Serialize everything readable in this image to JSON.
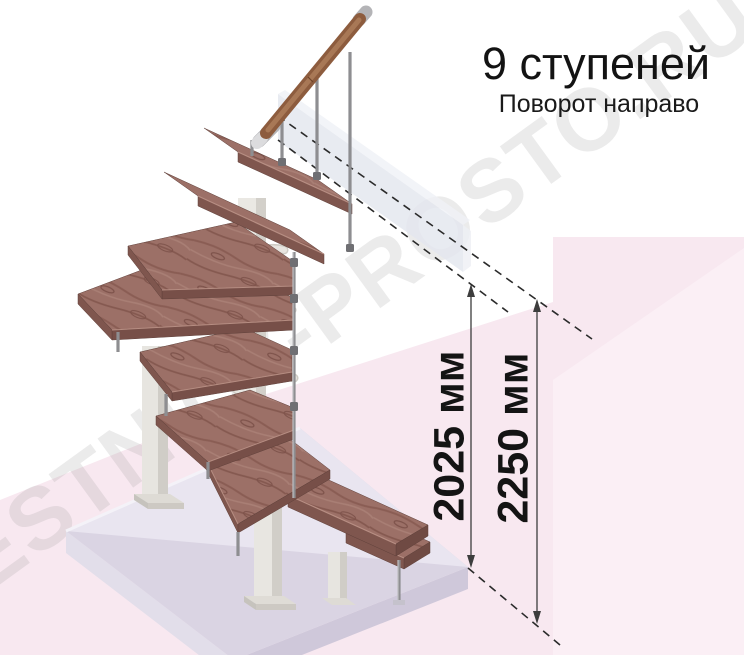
{
  "header": {
    "title": "9 ступеней",
    "subtitle": "Поворот направо"
  },
  "dimensions": [
    {
      "id": "clear-height",
      "label": "2025 мм"
    },
    {
      "id": "total-height",
      "label": "2250 мм"
    }
  ],
  "watermark": {
    "text": "LESTNICY-PROSTO.RU"
  },
  "illustration": {
    "type": "isometric-staircase",
    "steps_count": "9",
    "colors": {
      "wood": "#9c7067",
      "wood_edge": "#7f564e",
      "rail_wood": "#8d5c3e",
      "metal": "#8e8e91",
      "column_white": "#eae8e3",
      "floor_top": "#e9e5f0",
      "floor_side": "#cfc8da",
      "background_pink": "#f8e8f0",
      "ghost_panel": "#e4e7ef"
    }
  }
}
